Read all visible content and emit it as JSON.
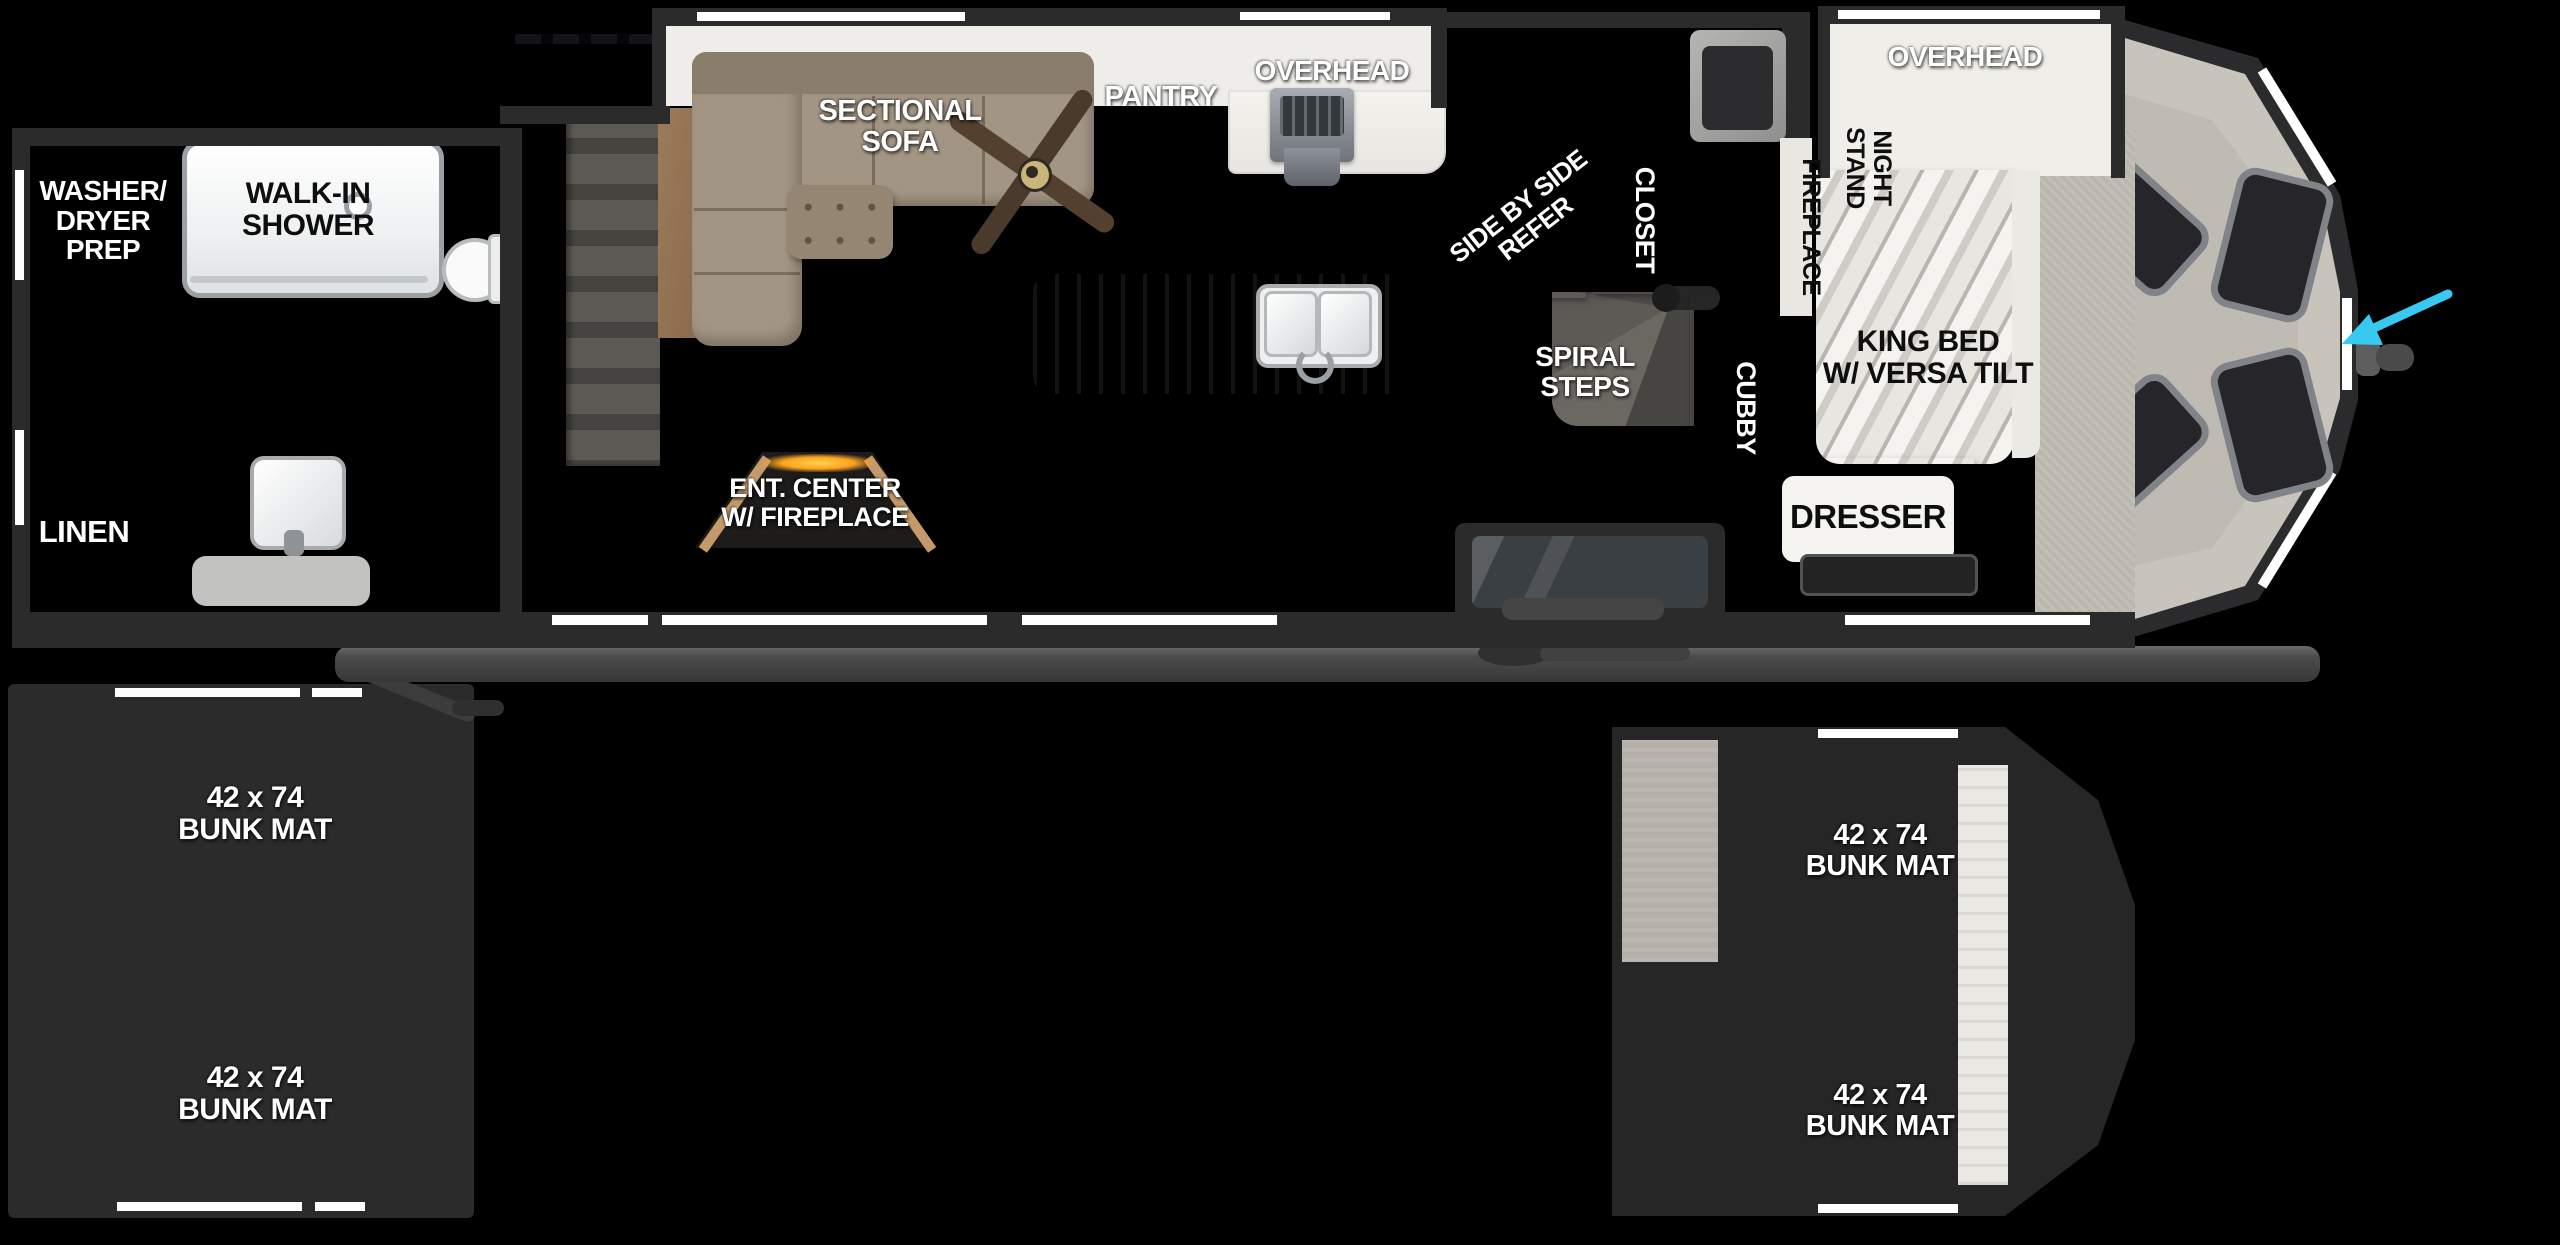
{
  "fp": {
    "bath": {
      "washer_dryer": "WASHER/\nDRYER\nPREP",
      "walk_in_shower": "WALK-IN\nSHOWER",
      "linen": "LINEN"
    },
    "living": {
      "sectional_sofa": "SECTIONAL\nSOFA",
      "pantry": "PANTRY",
      "overhead": "OVERHEAD",
      "ent_center": "ENT. CENTER\nW/ FIREPLACE"
    },
    "kitchen_entry": {
      "refer": "SIDE BY SIDE\nREFER",
      "closet": "CLOSET",
      "spiral_steps": "SPIRAL\nSTEPS",
      "cubby": "CUBBY"
    },
    "bedroom": {
      "overhead": "OVERHEAD",
      "night_stand": "NIGHT\nSTAND",
      "fireplace": "FIREPLACE",
      "king_bed": "KING BED\nW/ VERSA TILT",
      "dresser": "DRESSER"
    },
    "bunk_room_left": {
      "mats": [
        {
          "label": "42 x 74\nBUNK MAT"
        },
        {
          "label": "42 x 74\nBUNK MAT"
        }
      ]
    },
    "bunk_room_right": {
      "mats": [
        {
          "label": "42 x 74\nBUNK MAT"
        },
        {
          "label": "42 x 74\nBUNK MAT"
        }
      ]
    },
    "colors": {
      "background": "#000000",
      "walls": "#2b2b2b",
      "wood_cabinet": "#b58c63",
      "floor": "#d7d3cb",
      "carpet": "#9b948d",
      "bunk_mat": "#8d8680",
      "pointer_arrow": "#38c9f1",
      "fire_glow": "#ffa21f"
    }
  }
}
